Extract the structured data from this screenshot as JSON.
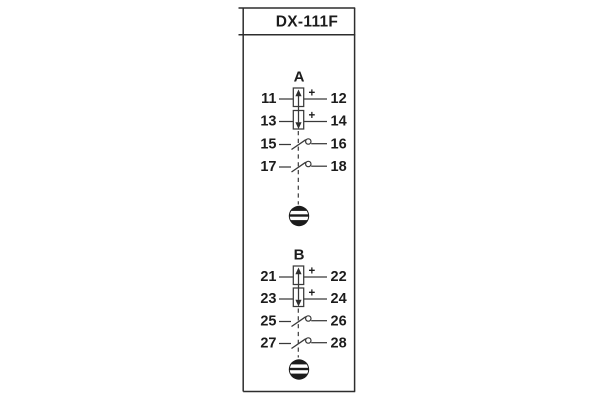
{
  "title": "DX-111F",
  "colors": {
    "line": "#3a3a3a",
    "frame": "#2d2d2d",
    "text": "#1c1c1c",
    "background": "#ffffff",
    "indicator_fill": "#1b1b1b",
    "indicator_slot": "#ffffff"
  },
  "icons": {
    "coil_up": "up-arrow-coil-icon",
    "coil_down": "down-arrow-coil-icon",
    "contact": "switch-contact-icon",
    "indicator": "target-disc-icon"
  },
  "sections": [
    {
      "label": "A",
      "coil_rows": [
        {
          "left": "11",
          "right": "12",
          "polarity": "+",
          "arrow": "up"
        },
        {
          "left": "13",
          "right": "14",
          "polarity": "+",
          "arrow": "down"
        }
      ],
      "contact_rows": [
        {
          "left": "15",
          "right": "16"
        },
        {
          "left": "17",
          "right": "18"
        }
      ]
    },
    {
      "label": "B",
      "coil_rows": [
        {
          "left": "21",
          "right": "22",
          "polarity": "+",
          "arrow": "up"
        },
        {
          "left": "23",
          "right": "24",
          "polarity": "+",
          "arrow": "down"
        }
      ],
      "contact_rows": [
        {
          "left": "25",
          "right": "26"
        },
        {
          "left": "27",
          "right": "28"
        }
      ]
    }
  ]
}
